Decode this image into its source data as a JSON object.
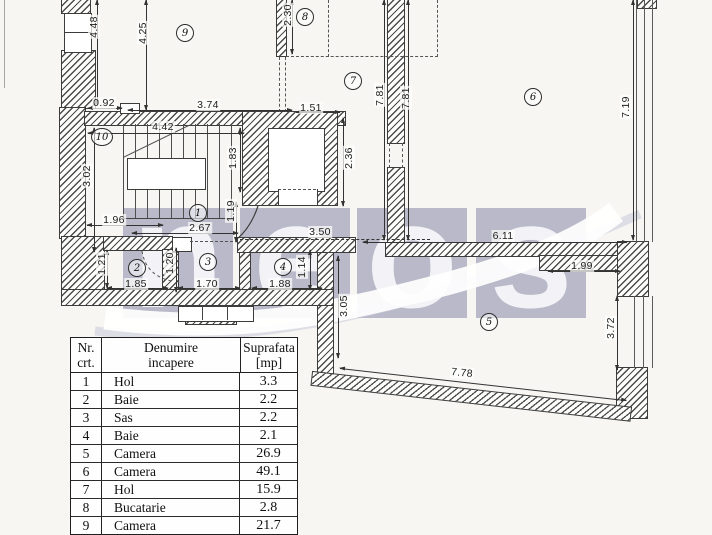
{
  "watermark": {
    "tile_color": "#b9b9c9",
    "letter_color": "#f3f3f7",
    "tiles": [
      {
        "letter": "n",
        "x": 123
      },
      {
        "letter": "e",
        "x": 240
      },
      {
        "letter": "o",
        "x": 357
      },
      {
        "letter": "s",
        "x": 476
      }
    ]
  },
  "plan": {
    "rooms": [
      {
        "number": "1",
        "x": 198,
        "y": 213
      },
      {
        "number": "2",
        "x": 137,
        "y": 268
      },
      {
        "number": "3",
        "x": 208,
        "y": 262
      },
      {
        "number": "4",
        "x": 283,
        "y": 267
      },
      {
        "number": "5",
        "x": 489,
        "y": 322
      },
      {
        "number": "6",
        "x": 533,
        "y": 97
      },
      {
        "number": "7",
        "x": 353,
        "y": 81
      },
      {
        "number": "8",
        "x": 305,
        "y": 17
      },
      {
        "number": "9",
        "x": 185,
        "y": 33
      },
      {
        "number": "10",
        "x": 102,
        "y": 137,
        "w": 20
      }
    ],
    "dimensions": [
      {
        "text": "4.48",
        "x": 94,
        "y": 27,
        "rot": true
      },
      {
        "text": "4.25",
        "x": 143,
        "y": 33,
        "rot": true
      },
      {
        "text": "2.30",
        "x": 288,
        "y": 15,
        "rot": true
      },
      {
        "text": "0.92",
        "x": 104,
        "y": 103
      },
      {
        "text": "3.74",
        "x": 208,
        "y": 105
      },
      {
        "text": "1.51",
        "x": 311,
        "y": 108
      },
      {
        "text": "4.42",
        "x": 163,
        "y": 127
      },
      {
        "text": "3.02",
        "x": 87,
        "y": 176,
        "rot": true
      },
      {
        "text": "1.83",
        "x": 233,
        "y": 158,
        "rot": true
      },
      {
        "text": "7.81",
        "x": 380,
        "y": 95,
        "rot": true
      },
      {
        "text": "7.81",
        "x": 406,
        "y": 98,
        "rot": true
      },
      {
        "text": "7.19",
        "x": 626,
        "y": 107,
        "rot": true
      },
      {
        "text": "2.36",
        "x": 349,
        "y": 158,
        "rot": true
      },
      {
        "text": "1.96",
        "x": 114,
        "y": 220
      },
      {
        "text": "2.67",
        "x": 200,
        "y": 228
      },
      {
        "text": "1.19",
        "x": 231,
        "y": 211,
        "rot": true
      },
      {
        "text": "3.50",
        "x": 320,
        "y": 232
      },
      {
        "text": "6.11",
        "x": 503,
        "y": 236
      },
      {
        "text": "1.21",
        "x": 102,
        "y": 264,
        "rot": true
      },
      {
        "text": "1.20",
        "x": 170,
        "y": 263,
        "rot": true
      },
      {
        "text": "1.85",
        "x": 136,
        "y": 284
      },
      {
        "text": "1.70",
        "x": 207,
        "y": 284
      },
      {
        "text": "1.88",
        "x": 280,
        "y": 284
      },
      {
        "text": "1.14",
        "x": 302,
        "y": 267,
        "rot": true
      },
      {
        "text": "3.05",
        "x": 344,
        "y": 306,
        "rot": true
      },
      {
        "text": "1.99",
        "x": 582,
        "y": 266
      },
      {
        "text": "3.72",
        "x": 611,
        "y": 328,
        "rot": true
      },
      {
        "text": "7.78",
        "x": 462,
        "y": 373,
        "tilt": true
      }
    ]
  },
  "table": {
    "headers": {
      "c1a": "Nr.",
      "c1b": "crt.",
      "c2a": "Denumire",
      "c2b": "incapere",
      "c3a": "Suprafata",
      "c3b": "[mp]"
    },
    "rows": [
      {
        "nr": "1",
        "name": "Hol",
        "area": "3.3"
      },
      {
        "nr": "2",
        "name": "Baie",
        "area": "2.2"
      },
      {
        "nr": "3",
        "name": "Sas",
        "area": "2.2"
      },
      {
        "nr": "4",
        "name": "Baie",
        "area": "2.1"
      },
      {
        "nr": "5",
        "name": "Camera",
        "area": "26.9"
      },
      {
        "nr": "6",
        "name": "Camera",
        "area": "49.1"
      },
      {
        "nr": "7",
        "name": "Hol",
        "area": "15.9"
      },
      {
        "nr": "8",
        "name": "Bucatarie",
        "area": "2.8"
      },
      {
        "nr": "9",
        "name": "Camera",
        "area": "21.7"
      }
    ]
  }
}
